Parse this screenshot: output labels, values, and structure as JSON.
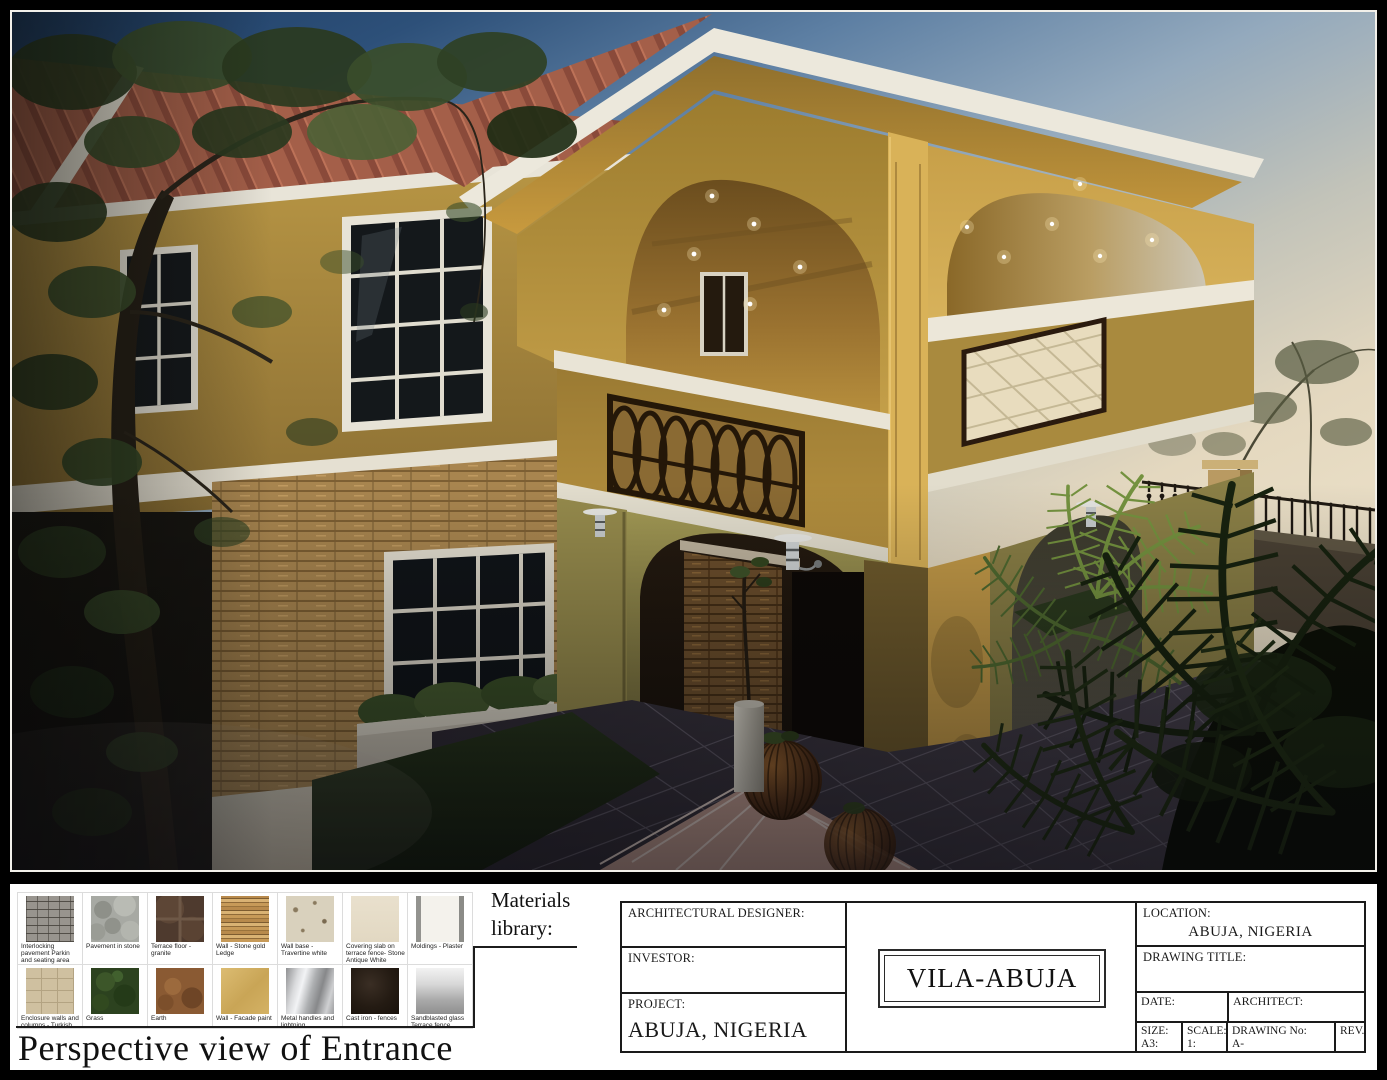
{
  "sheet": {
    "background_color": "#000000",
    "panel_color": "#ffffff",
    "caption": "Perspective view of Entrance",
    "materials_library_label": "Materials library:"
  },
  "render": {
    "description": "Dusk 3D rendering of a two-storey yellow stucco villa entrance: arched upper loggia with downlights, balcony with wrought-iron oval panel and quilted cream panel, stone-clad base, gridded windows, tiled forecourt with wicker planters, palms, garden fence and trees",
    "colors": {
      "sky_top": "#1d3c63",
      "sky_horizon": "#f0e6cf",
      "stucco_lit": "#c5a04a",
      "stucco_shade": "#8f7435",
      "white_trim": "#ece8dc",
      "roof_terracotta": "#a45f49",
      "stone_ledge": "#a8854f",
      "foliage_dark": "#2c3a22",
      "floor_tile": "#3a3440",
      "iron_panel": "#241708",
      "quilted_panel": "#e8dcbe"
    }
  },
  "materials": {
    "items": [
      {
        "name": "interlocking-pavement",
        "label": "Interlocking pavement Parkin and seating area"
      },
      {
        "name": "pavement-in-stone",
        "label": "Pavement in stone"
      },
      {
        "name": "terrace-floor-granite",
        "label": "Terrace floor - granite"
      },
      {
        "name": "wall-stone-gold-ledge",
        "label": "Wall - Stone gold Ledge"
      },
      {
        "name": "wall-base-travertine",
        "label": "Wall base - Travertine white"
      },
      {
        "name": "covering-slab",
        "label": "Covering slab on terrace fence- Stone Antique White"
      },
      {
        "name": "moldings-plaster",
        "label": "Moldings - Plaster"
      },
      {
        "name": "enclosure-walls",
        "label": "Enclosure walls and columns - Turkish stone"
      },
      {
        "name": "grass",
        "label": "Grass"
      },
      {
        "name": "earth",
        "label": "Earth"
      },
      {
        "name": "wall-facade-paint",
        "label": "Wall - Facade paint"
      },
      {
        "name": "metal-handles",
        "label": "Metal handles and lightning"
      },
      {
        "name": "cast-iron-fences",
        "label": "Cast iron - fences"
      },
      {
        "name": "sandblasted-glass",
        "label": "Sandblasted glass Terrace fence"
      }
    ]
  },
  "titleblock": {
    "architectural_designer_label": "ARCHITECTURAL DESIGNER:",
    "investor_label": "INVESTOR:",
    "project_label": "PROJECT:",
    "project_value": "ABUJA, NIGERIA",
    "villa_title": "VILA-ABUJA",
    "location_label": "LOCATION:",
    "location_value": "ABUJA, NIGERIA",
    "drawing_title_label": "DRAWING TITLE:",
    "date_label": "DATE:",
    "architect_label": "ARCHITECT:",
    "size_label": "SIZE:",
    "size_value": "A3:",
    "scale_label": "SCALE:",
    "scale_value": "1:",
    "drawing_no_label": "DRAWING No:",
    "drawing_no_value": "A-",
    "rev_label": "REV."
  }
}
